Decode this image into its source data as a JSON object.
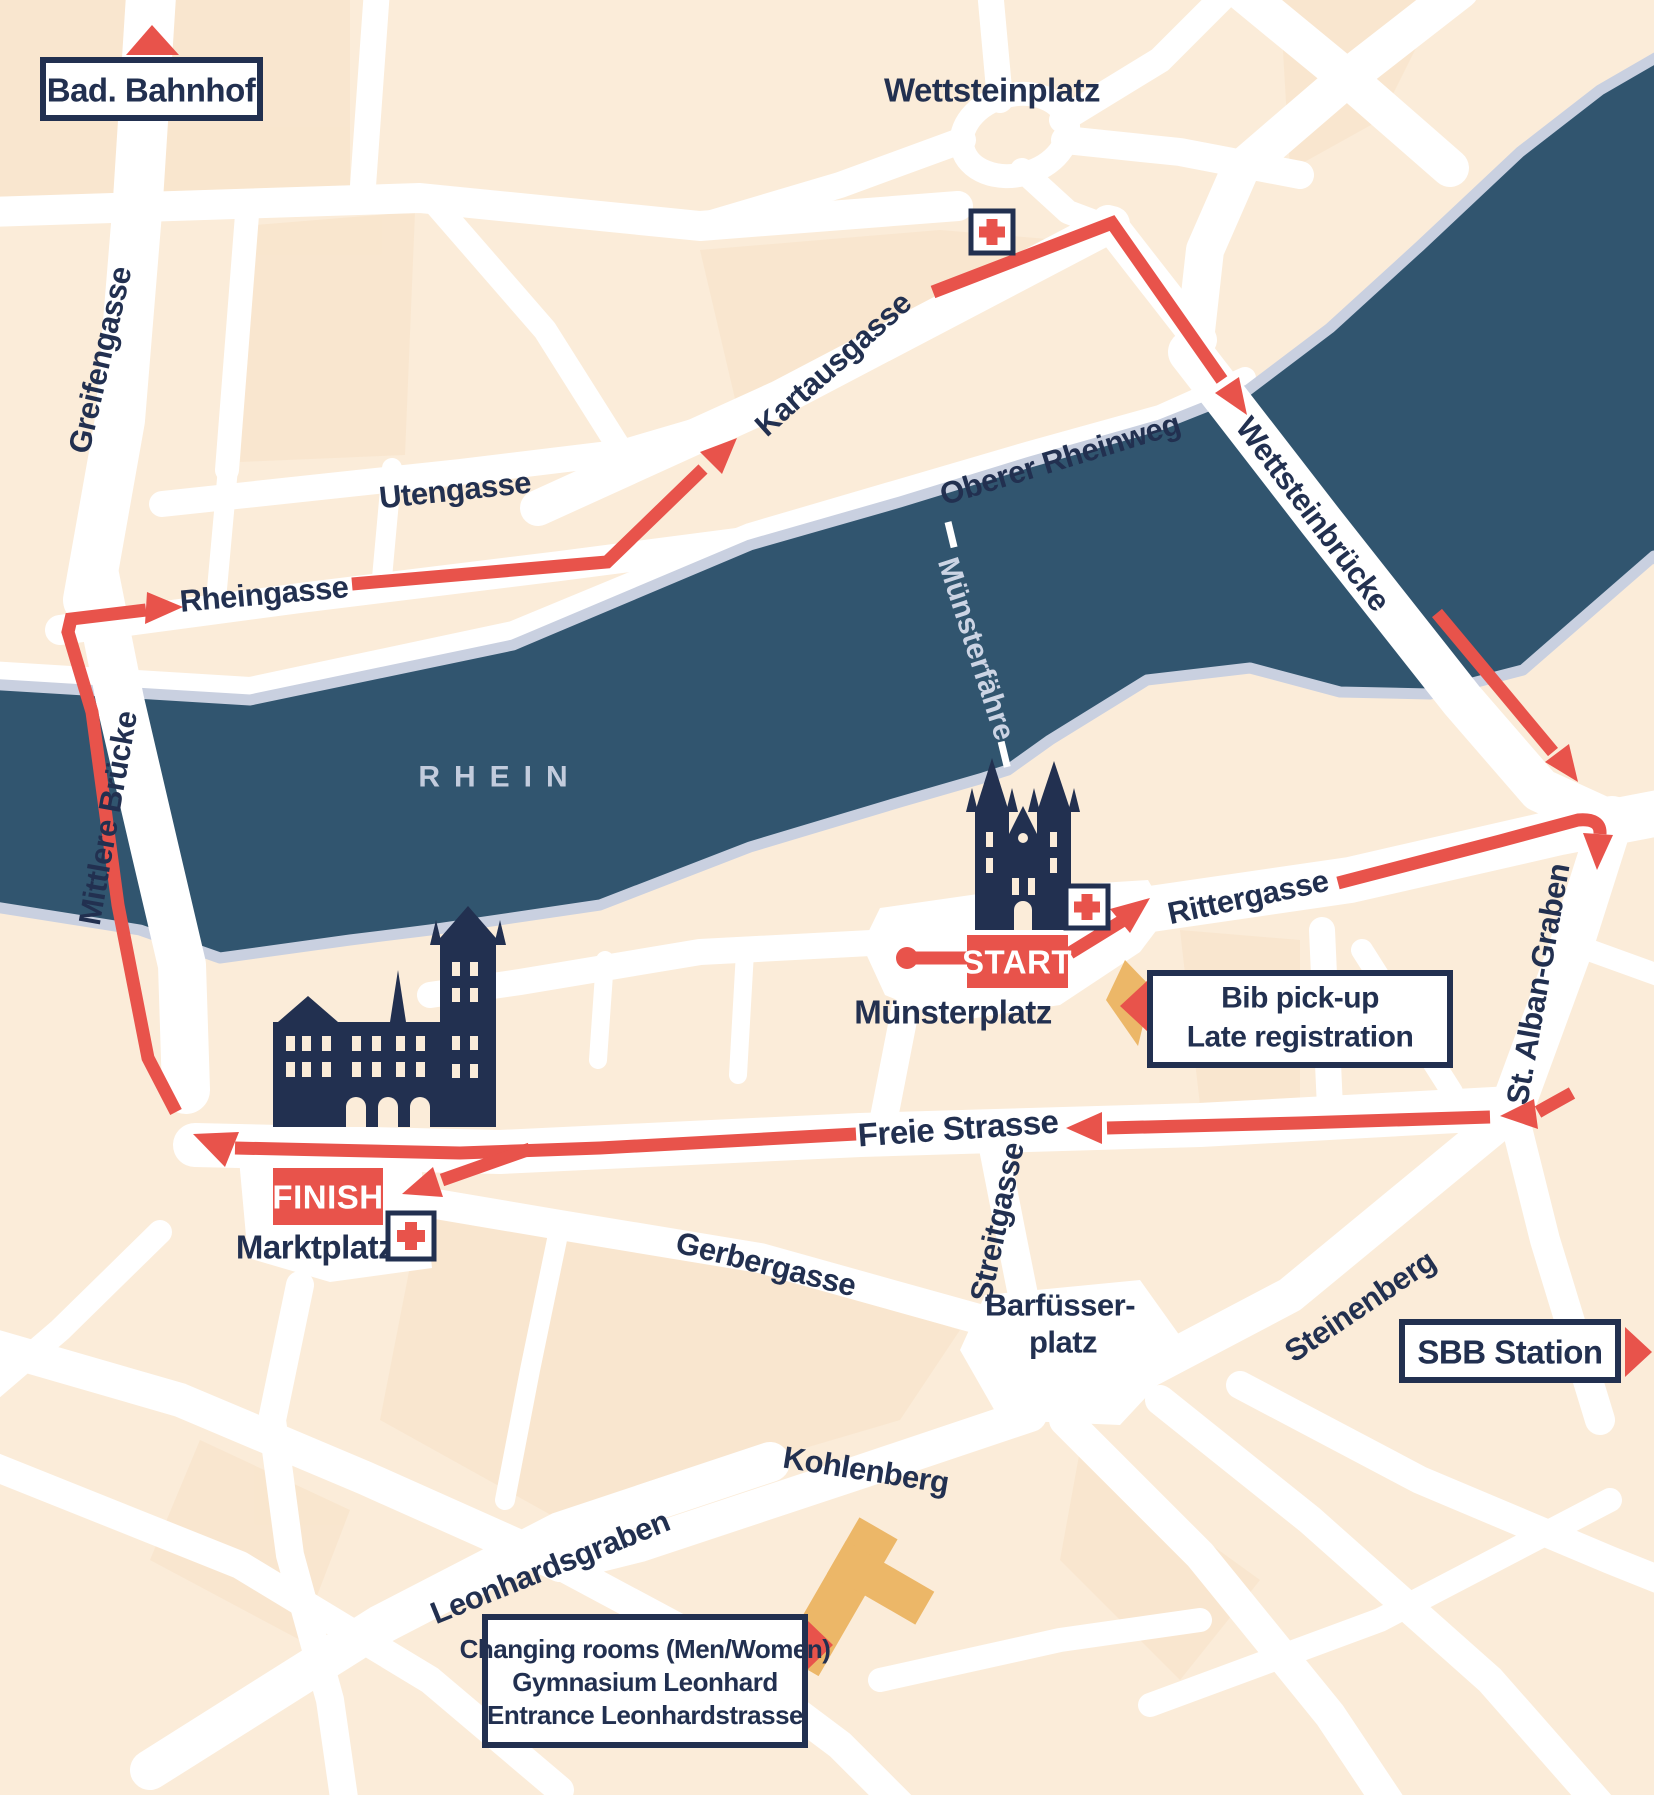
{
  "streets": {
    "greifengasse": "Greifengasse",
    "utengasse": "Utengasse",
    "rheingasse": "Rheingasse",
    "kartausgasse": "Kartausgasse",
    "oberer_rheinweg": "Oberer Rheinweg",
    "wettsteinbruecke": "Wettsteinbrücke",
    "mittlere_bruecke": "Mittlere Brücke",
    "rittergasse": "Rittergasse",
    "st_alban_graben": "St. Alban-Graben",
    "freie_strasse": "Freie Strasse",
    "streitgasse": "Streitgasse",
    "gerbergasse": "Gerbergasse",
    "steinenberg": "Steinenberg",
    "kohlenberg": "Kohlenberg",
    "leonhardsgraben": "Leonhardsgraben"
  },
  "places": {
    "wettsteinplatz": "Wettsteinplatz",
    "muensterplatz": "Münsterplatz",
    "marktplatz": "Marktplatz",
    "barfuesserplatz_line1": "Barfüsser-",
    "barfuesserplatz_line2": "platz",
    "rhein": "RHEIN",
    "muensterfaehre": "Münsterfähre"
  },
  "markers": {
    "start": "START",
    "finish": "FINISH",
    "bad_bahnhof": "Bad. Bahnhof",
    "sbb_station": "SBB Station",
    "bib_line1": "Bib pick-up",
    "bib_line2": "Late registration",
    "changing_line1": "Changing rooms (Men/Women)",
    "changing_line2": "Gymnasium Leonhard",
    "changing_line3": "Entrance Leonhardstrasse"
  },
  "icons": {
    "first_aid": "first-aid-cross",
    "up_triangle": "direction-arrow-up",
    "right_triangle": "direction-arrow-right",
    "left_triangle": "direction-arrow-left",
    "start_dot": "route-start-dot"
  },
  "colors": {
    "land": "#fbecd9",
    "block_shade": "#f8e2c6",
    "street": "#ffffff",
    "water": "#31556F",
    "shore": "#c9d0e0",
    "route_red": "#E8534B",
    "navy": "#223050",
    "building_orange": "#ECB768",
    "water_label": "#c3ccdd"
  }
}
